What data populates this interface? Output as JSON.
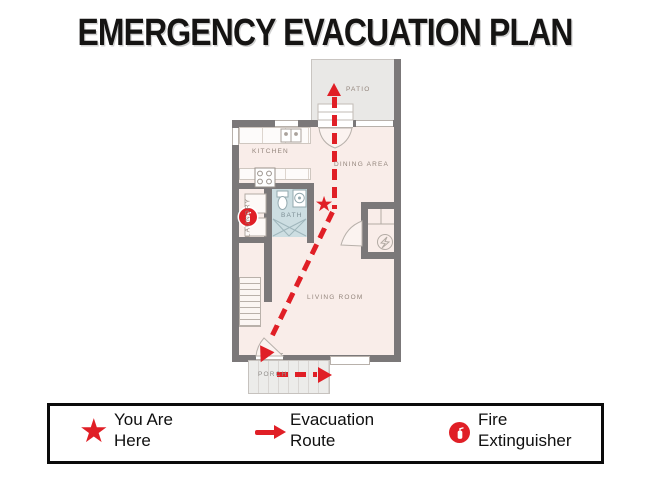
{
  "title": "EMERGENCY EVACUATION PLAN",
  "colors": {
    "route_red": "#e01f26",
    "wall_gray": "#7b7879",
    "floor_fill": "#f9ede9",
    "patio_fill": "#e9e8e6",
    "bath_fill": "#cddee2",
    "room_label": "#93857c"
  },
  "plan": {
    "rooms": [
      {
        "id": "patio",
        "label": "PATIO"
      },
      {
        "id": "kitchen",
        "label": "KITCHEN"
      },
      {
        "id": "dining",
        "label": "DINING AREA"
      },
      {
        "id": "bath",
        "label": "BATH"
      },
      {
        "id": "laundry",
        "label": "LAUNDRY"
      },
      {
        "id": "living",
        "label": "LIVING ROOM"
      },
      {
        "id": "porch",
        "label": "PORCH"
      }
    ],
    "markers": [
      {
        "id": "you-are-here",
        "type": "star"
      },
      {
        "id": "evacuation-route",
        "type": "dashed-arrow"
      },
      {
        "id": "fire-extinguisher",
        "type": "extinguisher"
      }
    ]
  },
  "legend": {
    "items": [
      {
        "icon": "star-icon",
        "line1": "You Are",
        "line2": "Here"
      },
      {
        "icon": "arrow-icon",
        "line1": "Evacuation",
        "line2": "Route"
      },
      {
        "icon": "fire-extinguisher-icon",
        "line1": "Fire",
        "line2": "Extinguisher"
      }
    ]
  }
}
